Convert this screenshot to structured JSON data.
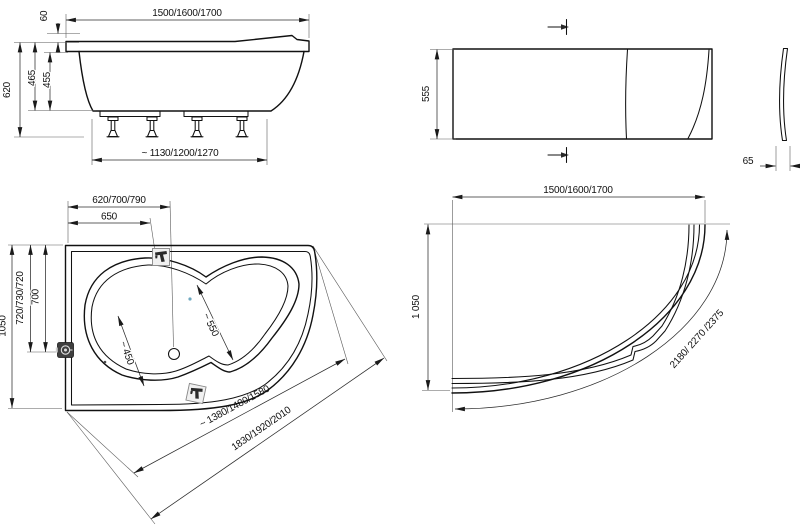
{
  "title": "Corner bathtub with apron panel - dimensional technical drawing",
  "colors": {
    "background": "#ffffff",
    "line": "#111111",
    "dimension": "#2b2b2b",
    "icon_dark": "#3f3f3f",
    "icon_light": "#f0f0f0",
    "jet_dot_blue": "#6fa8c0"
  },
  "views": {
    "side": {
      "label_length": "1500/1600/1700",
      "label_headrest_raise": "60",
      "label_total_height": "620",
      "label_height_outer": "465",
      "label_height_inner": "455",
      "label_base_length": "~ 1130/1200/1270"
    },
    "apron_front": {
      "label_height": "555",
      "label_thickness": "65"
    },
    "plan": {
      "label_width_variants": "620/700/790",
      "label_faucet_offset": "650",
      "label_depth_variants": "720/730/720",
      "label_depth": "700",
      "label_side": "1050",
      "label_seat_width": "~ 450",
      "label_bowl_width": "~ 550",
      "label_inner_diagonal": "~ 1380/1480/1580",
      "label_outer_diagonal": "1830/1920/2010"
    },
    "apron_plan": {
      "label_length": "1500/1600/1700",
      "label_width": "1 050",
      "label_arc_length": "2180/ 2270 /2375"
    }
  },
  "icons": {
    "faucet_top": "faucet-icon",
    "faucet_bottom": "faucet-icon",
    "overflow_drain": "drain-icon",
    "drain_hole": "drain-hole",
    "section_marker": "section-arrow-icon"
  }
}
